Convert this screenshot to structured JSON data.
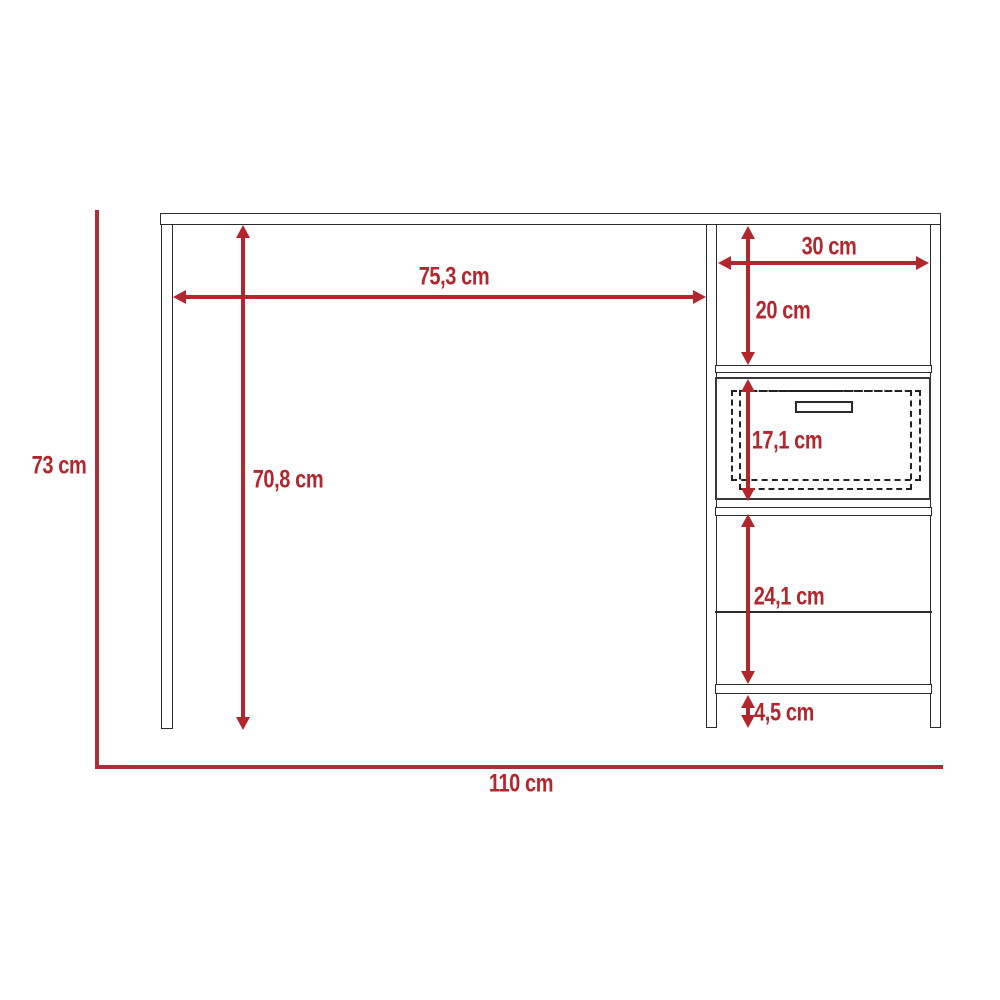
{
  "diagram": {
    "type": "furniture-dimension-drawing",
    "subject": "desk with side shelf unit and drawer, front elevation",
    "unit": "cm",
    "colors": {
      "dimension_red": "#b2262d",
      "boundary_red": "#a63138",
      "outline_dark": "#2b2b2b",
      "background": "#ffffff"
    },
    "dimensions": [
      {
        "name": "overall-height",
        "label": "73 cm",
        "value": 73,
        "orientation": "vertical"
      },
      {
        "name": "overall-width",
        "label": "110 cm",
        "value": 110,
        "orientation": "horizontal"
      },
      {
        "name": "desk-opening-width",
        "label": "75,3 cm",
        "value": 75.3,
        "orientation": "horizontal"
      },
      {
        "name": "desk-opening-height",
        "label": "70,8 cm",
        "value": 70.8,
        "orientation": "vertical"
      },
      {
        "name": "side-unit-inner-width",
        "label": "30 cm",
        "value": 30,
        "orientation": "horizontal"
      },
      {
        "name": "top-compartment-height",
        "label": "20 cm",
        "value": 20,
        "orientation": "vertical"
      },
      {
        "name": "drawer-height",
        "label": "17,1 cm",
        "value": 17.1,
        "orientation": "vertical"
      },
      {
        "name": "lower-compartment-height",
        "label": "24,1 cm",
        "value": 24.1,
        "orientation": "vertical"
      },
      {
        "name": "base-clearance-height",
        "label": "4,5 cm",
        "value": 4.5,
        "orientation": "vertical"
      }
    ]
  }
}
